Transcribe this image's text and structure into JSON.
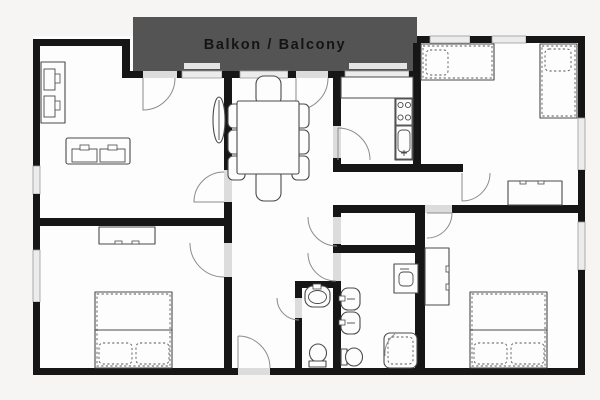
{
  "balcony": {
    "label": "Balkon / Balcony"
  },
  "colors": {
    "page_background": "#f6f5f3",
    "floor": "#fdfdfd",
    "wall": "#161616",
    "balcony_bg": "#545454",
    "balcony_text": "#141414",
    "window_fill": "#ececec",
    "door_opening": "#dcdcdc",
    "furniture_stroke": "#4a4a4a",
    "door_arc": "#8c8c8c"
  },
  "fixtures": {
    "living_room": [
      "wall-shelf",
      "sofa",
      "radiator"
    ],
    "dining_area": [
      "dining-table",
      "chair-x8"
    ],
    "kitchen": [
      "counter",
      "stove-4-burners",
      "kitchen-sink"
    ],
    "top_right_bedroom": [
      "single-bed",
      "single-bed",
      "desk"
    ],
    "bottom_left_bedroom": [
      "dresser",
      "double-bed"
    ],
    "bottom_right_bedroom": [
      "wardrobe",
      "double-bed"
    ],
    "wc": [
      "washbasin",
      "toilet"
    ],
    "bathroom": [
      "washbasin",
      "washbasin",
      "toilet",
      "corner-shower",
      "washing-machine"
    ],
    "hallway": [
      "entrance-door"
    ]
  }
}
